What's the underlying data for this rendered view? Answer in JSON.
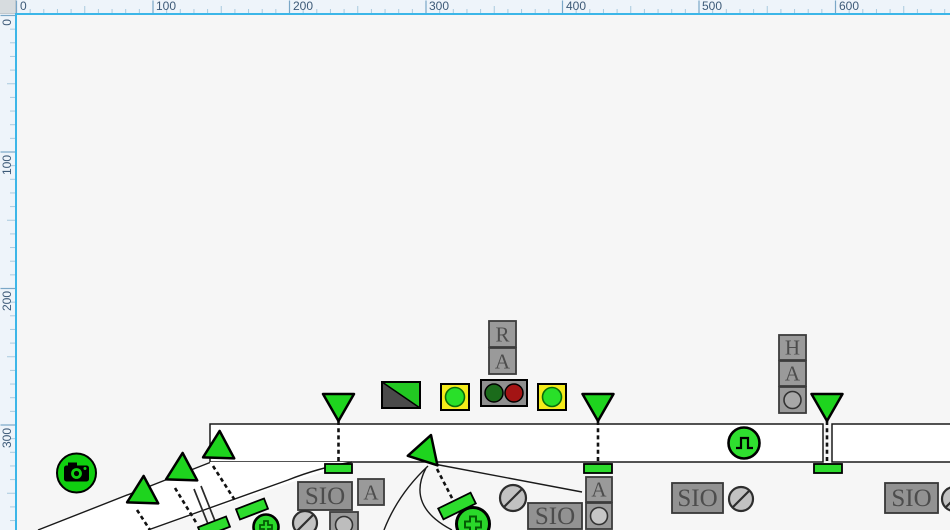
{
  "rulers": {
    "top": [
      "0",
      "100",
      "200",
      "300",
      "400",
      "500",
      "600"
    ],
    "left": [
      "0",
      "100",
      "200",
      "300"
    ]
  },
  "symbols": {
    "sio_label": "SIO",
    "indicator_r": "R",
    "indicator_a": "A",
    "indicator_h": "H"
  },
  "icon_names": [
    "camera-icon",
    "pulse-wave-icon",
    "plus-cross-icon",
    "no-entry-icon",
    "signal-triangle-icon",
    "route-split-indicator-icon",
    "lamp-green-icon",
    "lamp-red-icon",
    "lamp-yellow-icon"
  ],
  "colors": {
    "signal_green": "#1ed41e",
    "bar_green": "#2ddc2d",
    "lamp_yellow": "#f4eb1a",
    "lamp_dark_green": "#1b6b1b",
    "lamp_dark_red": "#a31414",
    "box_gray": "#999999",
    "ruler_accent": "#3cb6e8"
  }
}
